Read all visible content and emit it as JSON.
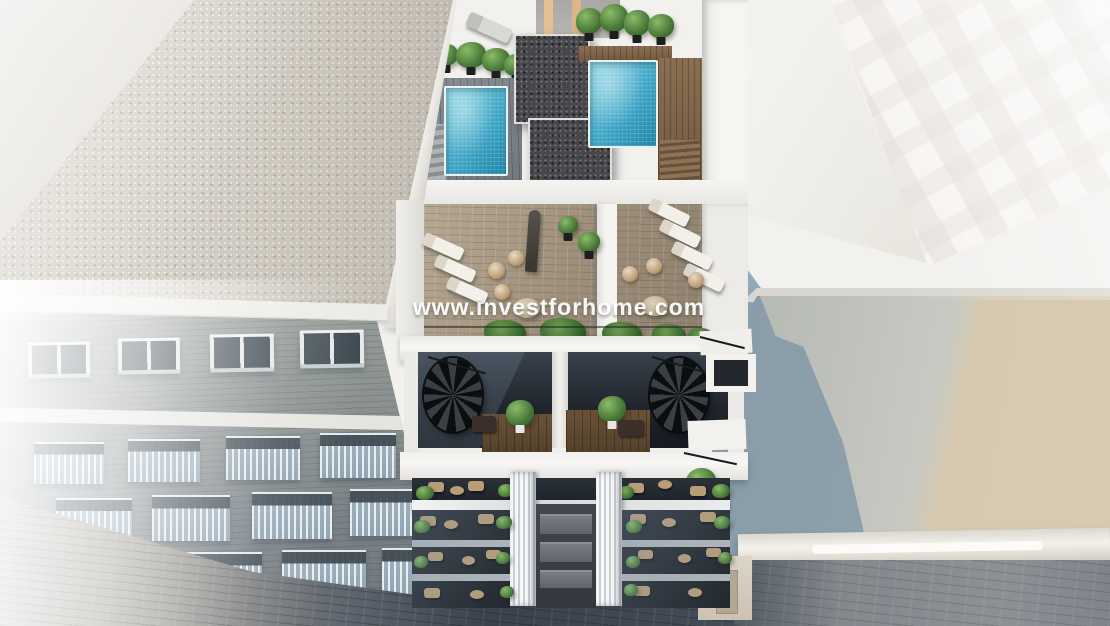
{
  "watermark": {
    "text": "www.investforhome.com"
  },
  "palette": {
    "building-white": "#f2f1ee",
    "left-roof-gravel": "#d4cfc6",
    "left-facade": "#8d9290",
    "window-glass": "#46525a",
    "balcony-railing": "#b0c2cd",
    "pavement-left": "#b7b2aa",
    "street-dark": "#39424d",
    "street-right": "#8d9196",
    "pool-blue": "#3ea6c6",
    "pool-light": "#82d2e3",
    "deck-wood": "#a39581",
    "roof-wood": "#8a6f52",
    "core-gravel": "#47474b",
    "plant-green": "#4e7e3b",
    "shade-blue": "#7e96a6",
    "right-roof": "#c5c7c1",
    "right-roof-beige": "#d8c9ac",
    "right-facade": "#f3f0ec",
    "watermark": "#ffffff"
  }
}
